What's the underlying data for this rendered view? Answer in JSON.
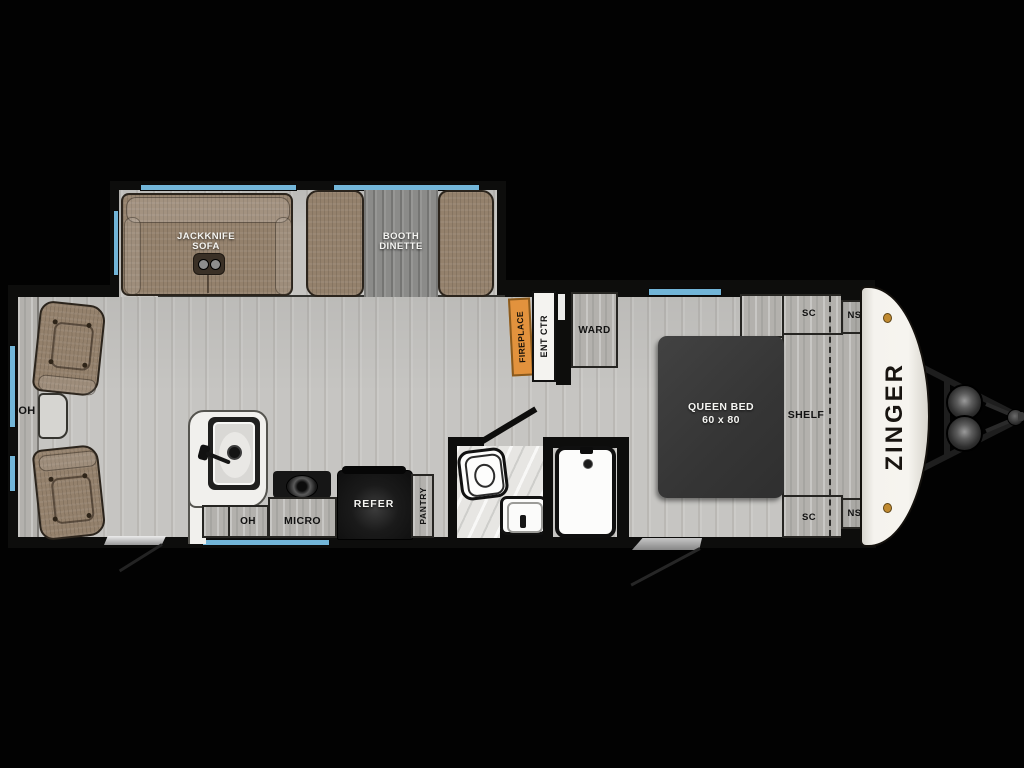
{
  "title": "Zinger travel trailer floor plan",
  "brand": "ZINGER",
  "labels": {
    "sofa_line1": "JACKKNIFE",
    "sofa_line2": "SOFA",
    "dinette_line1": "BOOTH",
    "dinette_line2": "DINETTE",
    "oh_left": "OH",
    "oh_kitchen": "OH",
    "micro": "MICRO",
    "refer": "REFER",
    "pantry": "PANTRY",
    "fireplace": "FIREPLACE",
    "ent_ctr": "ENT CTR",
    "ward": "WARD",
    "bed_line1": "QUEEN BED",
    "bed_line2": "60 x 80",
    "shelf": "SHELF",
    "sc_top": "SC",
    "ns_top": "NS",
    "sc_bottom": "SC",
    "ns_bottom": "NS"
  },
  "colors": {
    "background": "#020202",
    "wall": "#0d0d0c",
    "floor_gray": "#c6c5c2",
    "cabinet_gray": "#b3b1ad",
    "window_blue": "#72b5d8",
    "fireplace_orange": "#e2923d",
    "upholstery_brown": "#94816c",
    "bed_charcoal": "#383838",
    "appliance_black": "#141414",
    "cap_white": "#f3f1ec",
    "marker_light_amber": "#c08a30"
  }
}
